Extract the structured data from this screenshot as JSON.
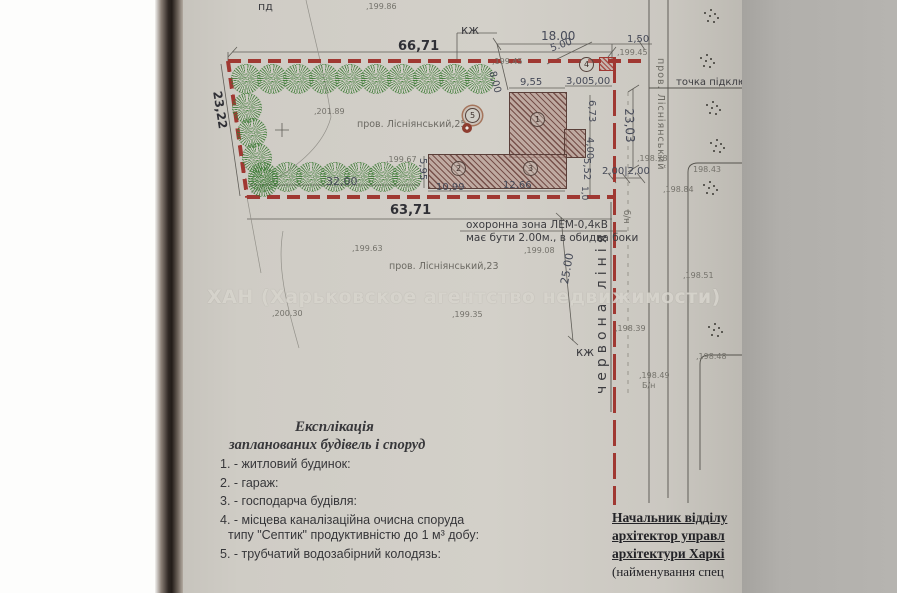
{
  "colors": {
    "paper": "#cfccc5",
    "boundary_red": "#a03832",
    "tree_green": "#3b7a34",
    "building_hatch": "#77514b",
    "ink": "#55534d",
    "dim_text": "#464a58"
  },
  "watermark": {
    "text": "ХАН (Харьковское агентство недвижимости)"
  },
  "plan": {
    "dims": [
      {
        "t": "66,71",
        "x": 398,
        "y": 39,
        "s": 13,
        "b": 1
      },
      {
        "t": "18.00",
        "x": 541,
        "y": 29,
        "s": 12
      },
      {
        "t": "5.00",
        "x": 549,
        "y": 44,
        "s": 10,
        "r": -20
      },
      {
        "t": "1,50",
        "x": 627,
        "y": 34,
        "s": 10
      },
      {
        "t": "8,00",
        "x": 497,
        "y": 70,
        "s": 10,
        "r": 75
      },
      {
        "t": "9,55",
        "x": 520,
        "y": 77,
        "s": 10
      },
      {
        "t": "3,00",
        "x": 566,
        "y": 76,
        "s": 10
      },
      {
        "t": "5,00",
        "x": 588,
        "y": 76,
        "s": 10
      },
      {
        "t": "6,73",
        "x": 597,
        "y": 100,
        "s": 10,
        "r": 90
      },
      {
        "t": "4,00",
        "x": 595,
        "y": 137,
        "s": 10,
        "r": 90
      },
      {
        "t": "5,52",
        "x": 592,
        "y": 158,
        "s": 10,
        "r": 90
      },
      {
        "t": "1,0",
        "x": 589,
        "y": 186,
        "s": 9,
        "r": 90
      },
      {
        "t": "5,95",
        "x": 428,
        "y": 158,
        "s": 10,
        "r": 90
      },
      {
        "t": "10,99",
        "x": 436,
        "y": 182,
        "s": 10
      },
      {
        "t": "12,66",
        "x": 503,
        "y": 180,
        "s": 10
      },
      {
        "t": "32,00",
        "x": 326,
        "y": 175,
        "s": 11
      },
      {
        "t": "63,71",
        "x": 390,
        "y": 203,
        "s": 13,
        "b": 1
      },
      {
        "t": "23,22",
        "x": 224,
        "y": 90,
        "s": 12,
        "r": 81,
        "b": 1
      },
      {
        "t": "23,03",
        "x": 636,
        "y": 108,
        "s": 12,
        "r": 88
      },
      {
        "t": "25.00",
        "x": 558,
        "y": 283,
        "s": 11,
        "r": -80
      },
      {
        "t": "2,00|2,00",
        "x": 602,
        "y": 166,
        "s": 10
      }
    ],
    "labels": [
      {
        "t": "пд",
        "x": 258,
        "y": 0,
        "s": 11,
        "d": 1
      },
      {
        "t": "кж",
        "x": 461,
        "y": 23,
        "s": 12,
        "d": 1
      },
      {
        "t": "кж",
        "x": 576,
        "y": 345,
        "s": 12,
        "d": 1
      },
      {
        "t": "пров. Лісніянський,25",
        "x": 357,
        "y": 119,
        "s": 9.5
      },
      {
        "t": "пров. Лісніянський,23",
        "x": 389,
        "y": 261,
        "s": 9.5
      },
      {
        "t": "охоронна зона ЛЕМ-0,4кВ",
        "x": 466,
        "y": 219,
        "s": 10.5,
        "d": 1
      },
      {
        "t": "має бути 2.00м., в обидва боки",
        "x": 466,
        "y": 232,
        "s": 10.5,
        "d": 1
      },
      {
        "t": "точка підключення",
        "x": 676,
        "y": 77,
        "s": 10,
        "d": 1
      },
      {
        "t": "червона лінія",
        "x": 594,
        "y": 394,
        "s": 14,
        "r": -90,
        "ls": 5,
        "d": 1
      },
      {
        "t": "пров. Лісніянський",
        "x": 666,
        "y": 58,
        "s": 9.5,
        "r": 90,
        "ls": 1
      },
      {
        "t": "б/н",
        "x": 631,
        "y": 210,
        "s": 8.5,
        "r": 90
      }
    ],
    "elevations": [
      {
        "t": ",199.86",
        "x": 366,
        "y": 2
      },
      {
        "t": ",199.45",
        "x": 492,
        "y": 57
      },
      {
        "t": ",199.45",
        "x": 617,
        "y": 48
      },
      {
        "t": ",201.89",
        "x": 314,
        "y": 107
      },
      {
        "t": ",199.67",
        "x": 386,
        "y": 155
      },
      {
        "t": ",199.08",
        "x": 524,
        "y": 246
      },
      {
        "t": ",199.63",
        "x": 352,
        "y": 244
      },
      {
        "t": ",200.30",
        "x": 272,
        "y": 309
      },
      {
        "t": ",199.35",
        "x": 452,
        "y": 310
      },
      {
        "t": ",198.78",
        "x": 637,
        "y": 154
      },
      {
        "t": "198.43",
        "x": 693,
        "y": 165
      },
      {
        "t": ",198.84",
        "x": 663,
        "y": 185
      },
      {
        "t": ",198.39",
        "x": 615,
        "y": 324
      },
      {
        "t": ",198.51",
        "x": 683,
        "y": 271
      },
      {
        "t": ",198.48",
        "x": 696,
        "y": 352
      },
      {
        "t": ",198.49",
        "x": 639,
        "y": 371
      },
      {
        "t": "Б/н",
        "x": 642,
        "y": 381
      }
    ],
    "trees": [
      [
        245,
        78
      ],
      [
        271,
        78
      ],
      [
        297,
        78
      ],
      [
        323,
        78
      ],
      [
        349,
        78
      ],
      [
        375,
        78
      ],
      [
        401,
        78
      ],
      [
        427,
        78
      ],
      [
        453,
        78
      ],
      [
        479,
        78
      ],
      [
        246,
        107
      ],
      [
        251,
        132
      ],
      [
        256,
        157
      ],
      [
        262,
        181
      ],
      [
        262,
        176
      ],
      [
        286,
        176
      ],
      [
        310,
        176
      ],
      [
        334,
        176
      ],
      [
        358,
        176
      ],
      [
        382,
        176
      ],
      [
        406,
        176
      ]
    ],
    "dot_clusters": [
      [
        704,
        12
      ],
      [
        700,
        57
      ],
      [
        706,
        104
      ],
      [
        710,
        142
      ],
      [
        703,
        184
      ],
      [
        708,
        326
      ]
    ],
    "circles": [
      {
        "t": "1",
        "x": 537,
        "y": 119
      },
      {
        "t": "2",
        "x": 458,
        "y": 168
      },
      {
        "t": "3",
        "x": 530,
        "y": 168
      },
      {
        "t": "4",
        "x": 586,
        "y": 64
      },
      {
        "t": "5",
        "x": 472,
        "y": 115,
        "dbl": 1
      }
    ],
    "well": {
      "x": 462,
      "y": 123
    }
  },
  "legend": {
    "title": "Експлікація",
    "subtitle": "запланованих будівель і споруд",
    "items": [
      "1. - житловий будинок:",
      "2. - гараж:",
      "3. - господарча будівля:",
      "4. - місцева каналізаційна очисна споруда",
      "типу \"Септик\" продуктивністю до 1 м³ добу:",
      "5. - трубчатий водозабірний колодязь:"
    ]
  },
  "signature": {
    "lines": [
      "Начальник відділу",
      "архітектор управл",
      "архітектури Харкі"
    ],
    "caption": "(найменування спец"
  }
}
